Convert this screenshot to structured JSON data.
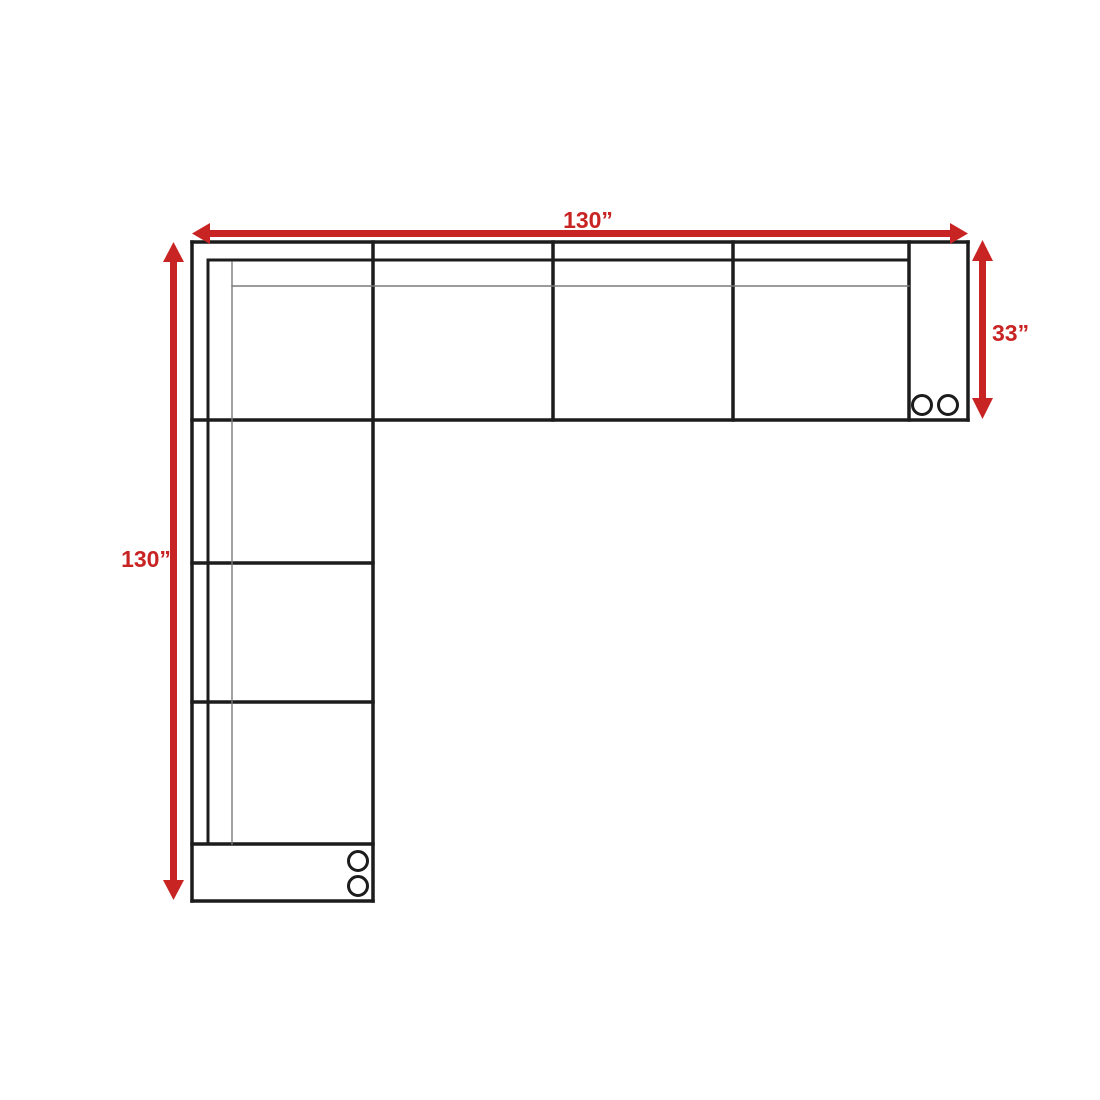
{
  "page": {
    "background": "#ffffff"
  },
  "diagram": {
    "type": "sectional-sofa-floor-plan-top-view",
    "colors": {
      "outline": "#1c1c1c",
      "seam": "#7a7a7a",
      "dimension": "#c92424",
      "caster_fill": "#ffffff"
    },
    "dimensions": {
      "top": {
        "label": "130”"
      },
      "left": {
        "label": "130”"
      },
      "right": {
        "label": "33”"
      }
    },
    "counts": {
      "horizontal_seats": 3,
      "vertical_seats": 3,
      "corner_seat": 1,
      "armrests": 2,
      "casters": 4
    }
  }
}
